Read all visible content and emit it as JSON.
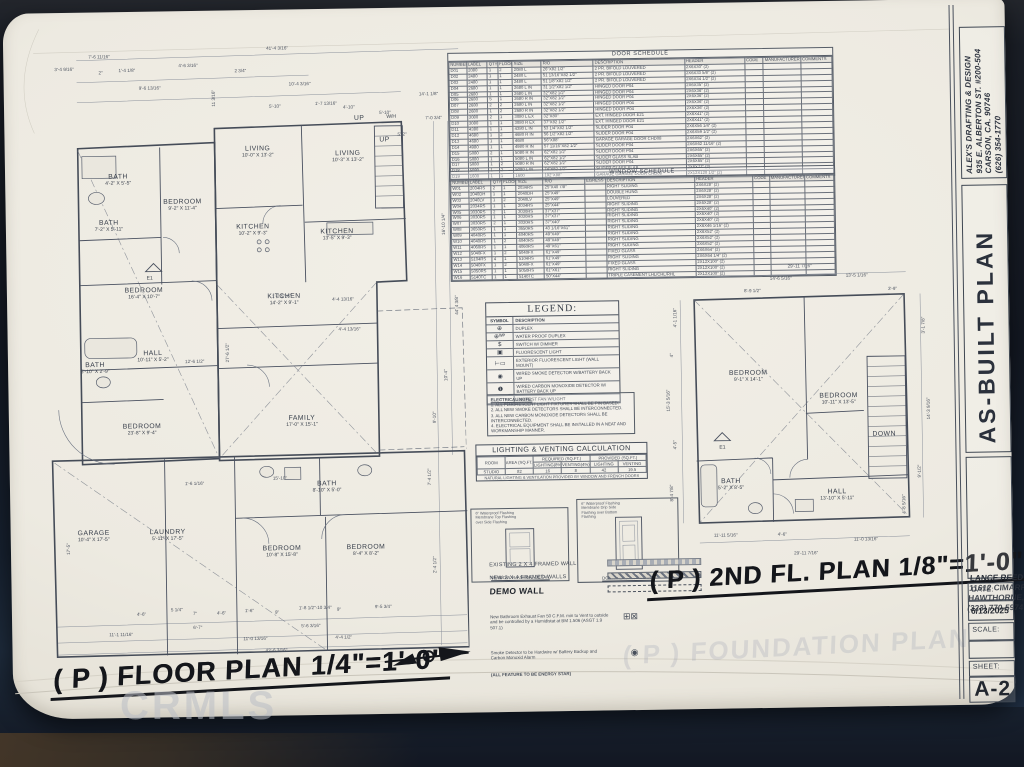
{
  "watermark": "CRMLS",
  "titleblock": {
    "firm_name": "ALEX'S DRAFTING & DESIGN",
    "firm_addr1": "935 E. ALBERTON ST. #200-504",
    "firm_addr2": "CARSON, CA. 90746",
    "firm_phone": "(626) 354-1770",
    "plan_title": "AS-BUILT PLAN",
    "client_name": "LANCE REED",
    "client_addr1": "11612 CIMARRON AVE.",
    "client_addr2": "HAWTHORNE, CA. 90250",
    "client_phone": "(323) 770-5974",
    "date_label": "DATE:",
    "date_value": "6/13/2025",
    "scale_label": "SCALE:",
    "sheet_label": "SHEET:",
    "sheet_value": "A-2"
  },
  "door_schedule": {
    "title": "DOOR SCHEDULE",
    "columns": [
      "NUMBER",
      "LABEL",
      "QTY",
      "FLOOR",
      "SIZE",
      "R/O",
      "DESCRIPTION",
      "HEADER",
      "CODE",
      "MANUFACTURER",
      "COMMENTS"
    ],
    "rows": [
      [
        "D01",
        "2080",
        "1",
        "2",
        "2080 L",
        "26\"X82 1/2\"",
        "2 PR. BIFOLD LOUVERED",
        "2X6X30\" (2)",
        "",
        "",
        ""
      ],
      [
        "D02",
        "2480",
        "1",
        "1",
        "2480 L",
        "51 13/16\"X82 1/2\"",
        "2 PR. BIFOLD LOUVERED",
        "2X6X33 5/8\" (2)",
        "",
        "",
        ""
      ],
      [
        "D03",
        "2480",
        "1",
        "1",
        "2480 L",
        "51 1/8\"X82 1/2\"",
        "2 PR. BIFOLD LOUVERED",
        "2X6X34 1/2\" (2)",
        "",
        "",
        ""
      ],
      [
        "D04",
        "2680",
        "1",
        "1",
        "2680 L IN",
        "31 1/2\"X82 1/2\"",
        "HINGED DOOR P04",
        "2X6X35\" (2)",
        "",
        "",
        ""
      ],
      [
        "D05",
        "2680",
        "1",
        "1",
        "2680 L IN",
        "32\"X82 1/2\"",
        "HINGED DOOR P04",
        "2X6X36\" (2)",
        "",
        "",
        ""
      ],
      [
        "D06",
        "2680",
        "5",
        "1",
        "2680 R IN",
        "32\"X82 1/2\"",
        "HINGED DOOR P04",
        "2X6X36\" (2)",
        "",
        "",
        ""
      ],
      [
        "D07",
        "2680",
        "2",
        "2",
        "2680 L IN",
        "32\"X82 1/2\"",
        "HINGED DOOR P04",
        "2X6X36\" (2)",
        "",
        "",
        ""
      ],
      [
        "D08",
        "2680",
        "1",
        "2",
        "2680 R IN",
        "32\"X82 1/2\"",
        "HINGED DOOR P04",
        "2X6X36\" (2)",
        "",
        "",
        ""
      ],
      [
        "D09",
        "3080",
        "2",
        "1",
        "3080 L EX",
        "32\"X80\"",
        "EXT. HINGED DOOR E21",
        "2X6X41\" (2)",
        "",
        "",
        ""
      ],
      [
        "D10",
        "3080",
        "1",
        "1",
        "3080 R EX",
        "37\"X82 1/2\"",
        "EXT. HINGED DOOR E21",
        "2X6X41\" (2)",
        "",
        "",
        ""
      ],
      [
        "D11",
        "4380",
        "1",
        "1",
        "4380 L IN",
        "53 1/4\"X82 1/2\"",
        "SLIDER DOOR P04",
        "2X6X56 1/4\" (2)",
        "",
        "",
        ""
      ],
      [
        "D12",
        "4680",
        "1",
        "2",
        "4680 R IN",
        "56 1/2\"X82 1/2\"",
        "SLIDER DOOR P04",
        "2X6X59 1/2\" (2)",
        "",
        "",
        ""
      ],
      [
        "D13",
        "4680",
        "1",
        "1",
        "4680",
        "56\"X88\"",
        "GARAGE GARAGE DOOR CHD08",
        "2X6X62\" (2)",
        "",
        "",
        ""
      ],
      [
        "D14",
        "4980",
        "1",
        "1",
        "4980 R IN",
        "57 11/16\"X82 1/2\"",
        "SLIDER DOOR P04",
        "2X6X62 11/16\" (2)",
        "",
        "",
        ""
      ],
      [
        "D15",
        "5080",
        "2",
        "1",
        "5080 R IN",
        "62\"X82 1/2\"",
        "SLIDER DOOR P04",
        "2X6X65\" (2)",
        "",
        "",
        ""
      ],
      [
        "D16",
        "5080",
        "1",
        "1",
        "5080 L IN",
        "62\"X82 1/2\"",
        "SLIDER GLASS SLAB",
        "2X6X65\" (2)",
        "",
        "",
        ""
      ],
      [
        "D17",
        "5080",
        "1",
        "2",
        "5080 R IN",
        "62\"X82 1/2\"",
        "SLIDER DOOR P04",
        "2X6X65\" (2)",
        "",
        "",
        ""
      ],
      [
        "D18",
        "5080",
        "1",
        "2",
        "5080 L IN",
        "74\"X82 1/2\"",
        "SLIDER GLASS SLAB",
        "2X6X77\" (2)",
        "",
        "",
        ""
      ],
      [
        "D19",
        "1600",
        "1",
        "1",
        "1600",
        "192\"X88\"",
        "GARAGE GARAGE DOOR CHD08",
        "2X12X120 1/2\" (2)",
        "",
        "",
        ""
      ]
    ]
  },
  "window_schedule": {
    "title": "WINDOW SCHEDULE",
    "columns": [
      "NUMBER",
      "LABEL",
      "QTY",
      "FLOOR",
      "SIZE",
      "R/O",
      "EGRESS",
      "DESCRIPTION",
      "HEADER",
      "CODE",
      "MANUFACTURER",
      "COMMENTS"
    ],
    "rows": [
      [
        "W01",
        "2034RS",
        "2",
        "1",
        "2034RS",
        "25\"X40 7/8\"",
        "",
        "RIGHT SLIDING",
        "2X6X28\" (2)",
        "",
        "",
        ""
      ],
      [
        "W02",
        "2040DH",
        "1",
        "1",
        "2040DH",
        "25\"X49\"",
        "",
        "DOUBLE HUNG",
        "2X6X28\" (2)",
        "",
        "",
        ""
      ],
      [
        "W03",
        "2040LV",
        "1",
        "2",
        "2040LV",
        "25\"X49\"",
        "",
        "LOUVERED",
        "2X6X28\" (2)",
        "",
        "",
        ""
      ],
      [
        "W04",
        "2034RS",
        "1",
        "1",
        "2034RS",
        "25\"X44\"",
        "",
        "RIGHT SLIDING",
        "2X6X28\" (2)",
        "",
        "",
        ""
      ],
      [
        "W05",
        "3030RS",
        "2",
        "1",
        "3030RS",
        "37\"X37\"",
        "",
        "RIGHT SLIDING",
        "2X6X40\" (2)",
        "",
        "",
        ""
      ],
      [
        "W06",
        "3030RS",
        "1",
        "1",
        "3030RS",
        "37\"X37\"",
        "",
        "RIGHT SLIDING",
        "2X6X40\" (2)",
        "",
        "",
        ""
      ],
      [
        "W07",
        "3030RS",
        "2",
        "1",
        "3030RS",
        "37\"X40\"",
        "",
        "RIGHT SLIDING",
        "2X6X40\" (2)",
        "",
        "",
        ""
      ],
      [
        "W08",
        "3650RS",
        "1",
        "1",
        "3650RS",
        "43 1/16\"X61\"",
        "",
        "RIGHT SLIDING",
        "2X6X46 1/16\" (2)",
        "",
        "",
        ""
      ],
      [
        "W09",
        "4040RS",
        "1",
        "1",
        "4040RS",
        "49\"X49\"",
        "",
        "RIGHT SLIDING",
        "2X6X52\" (2)",
        "",
        "",
        ""
      ],
      [
        "W10",
        "4040RS",
        "1",
        "2",
        "4040RS",
        "49\"X49\"",
        "",
        "RIGHT SLIDING",
        "2X6X52\" (2)",
        "",
        "",
        ""
      ],
      [
        "W11",
        "4060RS",
        "1",
        "1",
        "4060RS",
        "49\"X61\"",
        "",
        "RIGHT SLIDING",
        "2X6X52\" (2)",
        "",
        "",
        ""
      ],
      [
        "W12",
        "5040FX",
        "1",
        "2",
        "5040FX",
        "61\"X49\"",
        "",
        "FIXED GLASS",
        "2X6X64\" (2)",
        "",
        "",
        ""
      ],
      [
        "W13",
        "5104RS",
        "4",
        "1",
        "5104RS",
        "61\"X49\"",
        "",
        "RIGHT SLIDING",
        "2X6X64 1/4\" (2)",
        "",
        "",
        ""
      ],
      [
        "W14",
        "5040FX",
        "1",
        "2",
        "5040FX",
        "61\"X49\"",
        "",
        "FIXED GLASS",
        "2X12X100\" (2)",
        "",
        "",
        ""
      ],
      [
        "W15",
        "5050RS",
        "1",
        "1",
        "5050RS",
        "61\"X61\"",
        "",
        "RIGHT SLIDING",
        "2X12X100\" (2)",
        "",
        "",
        ""
      ],
      [
        "W16",
        "5140TC",
        "1",
        "1",
        "5140TC",
        "50\"X44\"",
        "",
        "TRIPLE CASEMENT LHL/CHL/RHL",
        "2X12X100\" (2)",
        "",
        "",
        ""
      ]
    ]
  },
  "legend": {
    "title": "LEGEND:",
    "col_symbol": "SYMBOL",
    "col_desc": "DESCRIPTION",
    "rows": [
      {
        "sym": "⊕",
        "desc": "DUPLEX"
      },
      {
        "sym": "⊕ᵂᴾ",
        "desc": "WATER PROOF DUPLEX"
      },
      {
        "sym": "$",
        "desc": "SWITCH W/ DIMMER"
      },
      {
        "sym": "▣",
        "desc": "FLUORESCENT LIGHT"
      },
      {
        "sym": "⊢▭",
        "desc": "EXTERIOR FLUORESCENT LIGHT (WALL MOUNT)"
      },
      {
        "sym": "◉",
        "desc": "WIRED SMOKE DETECTOR W/BATTERY BACK UP"
      },
      {
        "sym": "❶",
        "desc": "WIRED CARBON MONOXIDE DETECTOR W/ BATTERY BACK UP"
      },
      {
        "sym": "◔",
        "desc": "EXHAUST FAN W/LIGHT"
      }
    ]
  },
  "electrical_note": {
    "title": "ELECTRICAL NOTE:",
    "items": [
      "1.  ALL FLUORESCENT LIGHT FIXTURES SHALL BE PIN BASED.",
      "2.  ALL NEW SMOKE DETECTORS SHALL BE INTERCONNECTED.",
      "3.  ALL NEW CARBON MONOXIDE DETECTORS SHALL BE INTERCONNECTED.",
      "4.  ELECTRICAL EQUIPMENT SHALL BE INSTALLED IN A NEAT AND WORKMANSHIP MANNER."
    ]
  },
  "lighting_calc": {
    "title": "LIGHTING & VENTING CALCULATION",
    "h_room": "ROOM",
    "h_area": "AREA (SQ.FT.)",
    "h_req": "REQUIRED (SQ.FT.)",
    "h_prov": "PROVIDED (SQ.FT.)",
    "h_light_req": "LIGHTING(8%)",
    "h_vent_req": "VENTING(4%)",
    "h_light_prov": "LIGHTING",
    "h_vent_prov": "VENTING",
    "room": "STUDIO",
    "area": "82",
    "light_req": "16",
    "vent_req": "8",
    "light_prov": "42",
    "vent_prov": "19.5",
    "note": "NATURAL LIGHTING & VENTILATION PROVIDED BY WINDOW AND FRENCH DOORS"
  },
  "details": {
    "window_caption": "WINDOW FLASHING DETAIL",
    "door_caption": "DOOR FLASHING DETAIL",
    "ann1": "6\" Waterproof Flashing Membrane Top Flashing over Side Flashing",
    "ann2": "6\" Waterproof Flashing Membrane Drip Side Flashing over Bottom Flashing"
  },
  "wall_legend": {
    "existing": "EXISTING 2 X 4 FRAMED WALL",
    "new": "NEW  2 X 4 FRAMED  WALLS",
    "demo": "DEMO WALL",
    "fan_note": "New Bathroom Exhaust Fan 50 C.F.M. min to Vent to outside and be controlled by a Humidistat at BM 1.506 (ASGT 1.9 507.1)",
    "fan_glyph": "⊞⊠",
    "smoke_note": "Smoke Detector to be Hardwire w/ Battery Backup and Carbon Monoxid Alarm",
    "smoke_glyph": "◉",
    "energy_note": "(ALL FEATURE TO BE ENERGY STAR)"
  },
  "floor_plan": {
    "title": "( P ) FLOOR PLAN 1/4\"=1'-0\"",
    "markers": {
      "e1": "E1",
      "wh": "W/H"
    },
    "rooms": [
      {
        "name": "BATH",
        "dims": "4'-2\" X 5'-5\"",
        "x": 88,
        "y": 150
      },
      {
        "name": "BATH",
        "dims": "7'-2\" X 5'-11\"",
        "x": 78,
        "y": 196
      },
      {
        "name": "BEDROOM",
        "dims": "9'-2\" X 11'-4\"",
        "x": 152,
        "y": 176
      },
      {
        "name": "LIVING",
        "dims": "10'-0\" X 13'-2\"",
        "x": 228,
        "y": 124
      },
      {
        "name": "LIVING",
        "dims": "10'-3\" X 13'-2\"",
        "x": 318,
        "y": 130
      },
      {
        "name": "KITCHEN",
        "dims": "10'-2\" X 9'-3\"",
        "x": 222,
        "y": 202
      },
      {
        "name": "KITCHEN",
        "dims": "13'-5\" X 9'-3\"",
        "x": 306,
        "y": 208
      },
      {
        "name": "BEDROOM",
        "dims": "16'-4\" X 10'-7\"",
        "x": 112,
        "y": 264
      },
      {
        "name": "KITCHEN",
        "dims": "14'-2\" X 9'-1\"",
        "x": 252,
        "y": 272
      },
      {
        "name": "HALL",
        "dims": "10'-11\" X 5'-2\"",
        "x": 120,
        "y": 327
      },
      {
        "name": "BATH",
        "dims": "5'-10\" X 2'-9\"",
        "x": 62,
        "y": 338
      },
      {
        "name": "BEDROOM",
        "dims": "23'-8\" X 9'-4\"",
        "x": 108,
        "y": 400
      },
      {
        "name": "FAMILY",
        "dims": "17'-0\" X 15'-1\"",
        "x": 268,
        "y": 394
      },
      {
        "name": "GARAGE",
        "dims": "10'-4\" X 17'-5\"",
        "x": 58,
        "y": 506
      },
      {
        "name": "LAUNDRY",
        "dims": "5'-11\" X 17'-5\"",
        "x": 132,
        "y": 506
      },
      {
        "name": "BATH",
        "dims": "8'-10\" X 5'-0\"",
        "x": 292,
        "y": 460
      },
      {
        "name": "BEDROOM",
        "dims": "10'-8\" X 15'-8\"",
        "x": 246,
        "y": 524
      },
      {
        "name": "BEDROOM",
        "dims": "8'-4\" X 8'-2\"",
        "x": 330,
        "y": 524
      },
      {
        "name": "UP",
        "dims": "",
        "x": 330,
        "y": 92
      },
      {
        "name": "UP",
        "dims": "",
        "x": 355,
        "y": 114
      }
    ],
    "dims": [
      {
        "t": "7'-6 11/16\"",
        "x": 60,
        "y": 24
      },
      {
        "t": "41'-4 3/16\"",
        "x": 238,
        "y": 18
      },
      {
        "t": "3'-4 9/16\"",
        "x": 26,
        "y": 36
      },
      {
        "t": "2\"",
        "x": 70,
        "y": 40
      },
      {
        "t": "1'-4 1/8\"",
        "x": 90,
        "y": 38
      },
      {
        "t": "4'-6 3/16\"",
        "x": 150,
        "y": 34
      },
      {
        "t": "2 3/4\"",
        "x": 206,
        "y": 40
      },
      {
        "t": "9'-6 13/16\"",
        "x": 110,
        "y": 56
      },
      {
        "t": "10'-4 3/16\"",
        "x": 260,
        "y": 54
      },
      {
        "t": "5'-10\"",
        "x": 240,
        "y": 76
      },
      {
        "t": "1'-7 13/16\"",
        "x": 286,
        "y": 74
      },
      {
        "t": "4'-10\"",
        "x": 314,
        "y": 78
      },
      {
        "t": "5'-10\"",
        "x": 350,
        "y": 84
      },
      {
        "t": "14'-1 1/8\"",
        "x": 390,
        "y": 66
      },
      {
        "t": "7'-0 3/4\"",
        "x": 396,
        "y": 90
      },
      {
        "t": "11 3/16\"",
        "x": 182,
        "y": 78,
        "r": -90
      },
      {
        "t": "5'-2\"",
        "x": 368,
        "y": 106
      },
      {
        "t": "12'-6 1/2\"",
        "x": 152,
        "y": 330
      },
      {
        "t": "27'-6 1/2\"",
        "x": 192,
        "y": 334,
        "r": -90
      },
      {
        "t": "1'-2 5/16\"",
        "x": 240,
        "y": 266
      },
      {
        "t": "4'-4 13/16\"",
        "x": 300,
        "y": 270
      },
      {
        "t": "4'-4 13/16\"",
        "x": 306,
        "y": 300
      },
      {
        "t": "16'-10 1/4\"",
        "x": 410,
        "y": 210,
        "r": -90
      },
      {
        "t": "44'-4 3/8\"",
        "x": 422,
        "y": 290,
        "r": -90
      },
      {
        "t": "10'-4\"",
        "x": 410,
        "y": 356,
        "r": -90
      },
      {
        "t": "9'-10\"",
        "x": 398,
        "y": 398,
        "r": -90
      },
      {
        "t": "7'-4 1/2\"",
        "x": 392,
        "y": 460,
        "r": -90
      },
      {
        "t": "2'-4 1/2\"",
        "x": 396,
        "y": 548,
        "r": -90
      },
      {
        "t": "1'-6 1/16\"",
        "x": 150,
        "y": 452
      },
      {
        "t": "15'-10\"",
        "x": 238,
        "y": 448
      },
      {
        "t": "17'-5\"",
        "x": 30,
        "y": 524,
        "r": -90
      },
      {
        "t": "4'-6\"",
        "x": 100,
        "y": 582
      },
      {
        "t": "5 1/4\"",
        "x": 134,
        "y": 578
      },
      {
        "t": "7\"",
        "x": 156,
        "y": 582
      },
      {
        "t": "4'-6\"",
        "x": 180,
        "y": 582
      },
      {
        "t": "1'-6\"",
        "x": 208,
        "y": 580
      },
      {
        "t": "9\"",
        "x": 238,
        "y": 582
      },
      {
        "t": "1'-8 1/2\"-10 3/4\"",
        "x": 262,
        "y": 578
      },
      {
        "t": "9\"",
        "x": 300,
        "y": 580
      },
      {
        "t": "9'-5 3/4\"",
        "x": 338,
        "y": 578
      },
      {
        "t": "6'-7\"",
        "x": 156,
        "y": 596
      },
      {
        "t": "5'-6 3/16\"",
        "x": 264,
        "y": 596
      },
      {
        "t": "11'-0 13/16\"",
        "x": 206,
        "y": 608
      },
      {
        "t": "4'-4 1/2\"",
        "x": 298,
        "y": 608
      },
      {
        "t": "11'-1 11/16\"",
        "x": 72,
        "y": 602
      },
      {
        "t": "43'-6 3/16\"",
        "x": 228,
        "y": 620
      }
    ]
  },
  "second_floor": {
    "title": "( P ) 2ND FL. PLAN 1/8\"=1'-0\"",
    "rooms": [
      {
        "name": "BEDROOM",
        "dims": "9'-1\" X 14'-1\"",
        "x": 95,
        "y": 112
      },
      {
        "name": "BEDROOM",
        "dims": "10'-11\" X 13'-5\"",
        "x": 185,
        "y": 136
      },
      {
        "name": "BATH",
        "dims": "5'-2\" X 8'-5\"",
        "x": 76,
        "y": 220
      },
      {
        "name": "HALL",
        "dims": "13'-10\" X 5'-11\"",
        "x": 182,
        "y": 232
      },
      {
        "name": "DOWN",
        "dims": "",
        "x": 230,
        "y": 172
      }
    ],
    "dims": [
      {
        "t": "29'-11 7/16\"",
        "x": 136,
        "y": 0
      },
      {
        "t": "14'-6 5/16\"",
        "x": 118,
        "y": 12
      },
      {
        "t": "8'-9 1/2\"",
        "x": 92,
        "y": 24
      },
      {
        "t": "13'-5 1/16\"",
        "x": 194,
        "y": 10
      },
      {
        "t": "3'-9\"",
        "x": 236,
        "y": 24
      },
      {
        "t": "4'-1 1/16\"",
        "x": 20,
        "y": 62,
        "r": -90
      },
      {
        "t": "4\"",
        "x": 16,
        "y": 92,
        "r": -90
      },
      {
        "t": "15'-3 5/16\"",
        "x": 12,
        "y": 146,
        "r": -90
      },
      {
        "t": "4'-5\"",
        "x": 18,
        "y": 184,
        "r": -90
      },
      {
        "t": "8'-4 7/8\"",
        "x": 14,
        "y": 236,
        "r": -90
      },
      {
        "t": "3'-1 7/8\"",
        "x": 268,
        "y": 72,
        "r": -90
      },
      {
        "t": "14'-3 9/16\"",
        "x": 272,
        "y": 158,
        "r": -90
      },
      {
        "t": "9'-1/2\"",
        "x": 262,
        "y": 216,
        "r": -90
      },
      {
        "t": "4'-8 5/16\"",
        "x": 246,
        "y": 252,
        "r": -90
      },
      {
        "t": "11'-11 5/16\"",
        "x": 58,
        "y": 268
      },
      {
        "t": "4'-6\"",
        "x": 122,
        "y": 268
      },
      {
        "t": "11'-0 13/16\"",
        "x": 198,
        "y": 274
      },
      {
        "t": "29'-11 7/16\"",
        "x": 138,
        "y": 287
      }
    ]
  },
  "ghost_text": "( P ) FOUNDATION PLAN"
}
